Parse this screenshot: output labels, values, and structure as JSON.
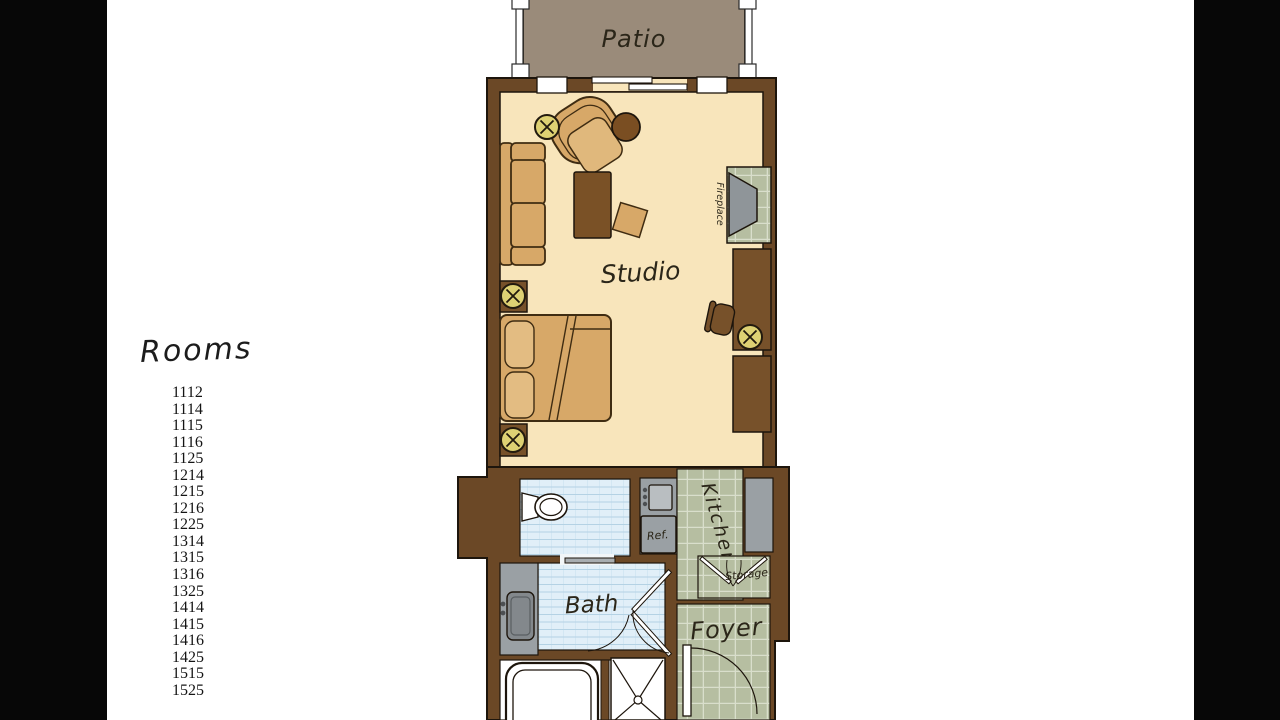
{
  "rooms_panel": {
    "heading": "Rooms",
    "items": [
      "1112",
      "1114",
      "1115",
      "1116",
      "1125",
      "1214",
      "1215",
      "1216",
      "1225",
      "1314",
      "1315",
      "1316",
      "1325",
      "1414",
      "1415",
      "1416",
      "1425",
      "1515",
      "1525"
    ]
  },
  "floorplan": {
    "labels": {
      "patio": "Patio",
      "studio": "Studio",
      "fireplace": "Fireplace",
      "kitchen": "Kitchen",
      "storage": "Storage",
      "foyer": "Foyer",
      "bath": "Bath",
      "ref": "Ref."
    },
    "colors": {
      "wall_brown": "#6b4826",
      "floor_cream": "#f8e5bb",
      "furniture_tan": "#d7a868",
      "furniture_dark_brown": "#77512a",
      "patio_taupe": "#9a8b7a",
      "tile_green": "#b6bea1",
      "tile_blue": "#e1eff8",
      "fixture_gray": "#9aa0a4",
      "light_symbol_yellow": "#ded173",
      "background_bars": "#070707"
    }
  }
}
